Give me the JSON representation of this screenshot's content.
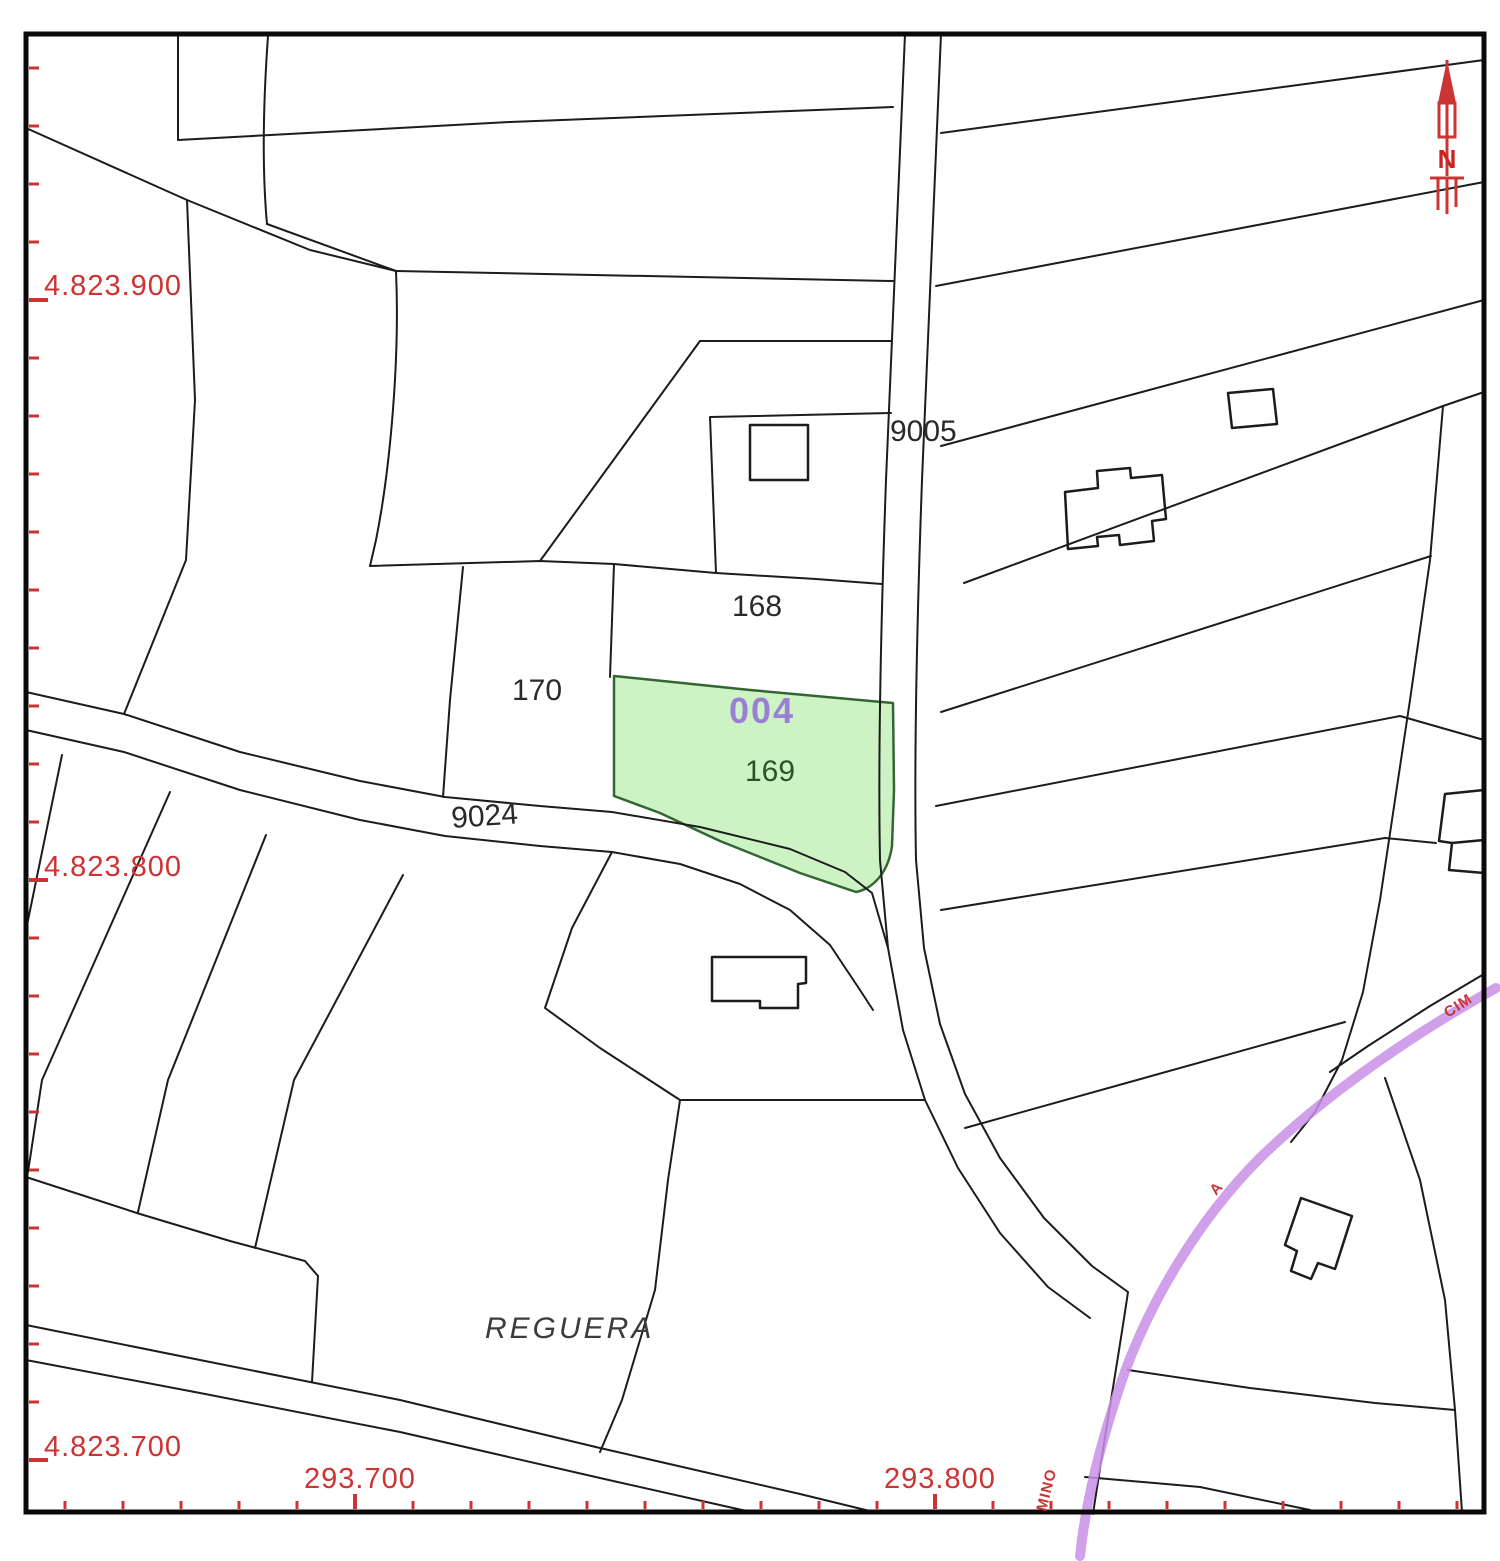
{
  "parcels": {
    "highlight_code": "004",
    "highlight_number": "169",
    "p168": "168",
    "p170": "170",
    "road_a": "9005",
    "road_b": "9024"
  },
  "place_name": "REGUERA",
  "axis": {
    "y_labels": [
      "4.823.900",
      "4.823.800",
      "4.823.700"
    ],
    "x_labels": [
      "293.700",
      "293.800"
    ]
  },
  "road_name_fragments": {
    "upper": "CIM",
    "middle": "A",
    "lower": "MINO"
  },
  "north_letter": "N",
  "colors": {
    "highlight_fill": "#cdf3c5",
    "highlight_stroke": "#336633",
    "camino": "#c98fe6",
    "grid_red": "#cc3333",
    "code_purple": "#9b7fd4",
    "line": "#1c1c1c"
  }
}
